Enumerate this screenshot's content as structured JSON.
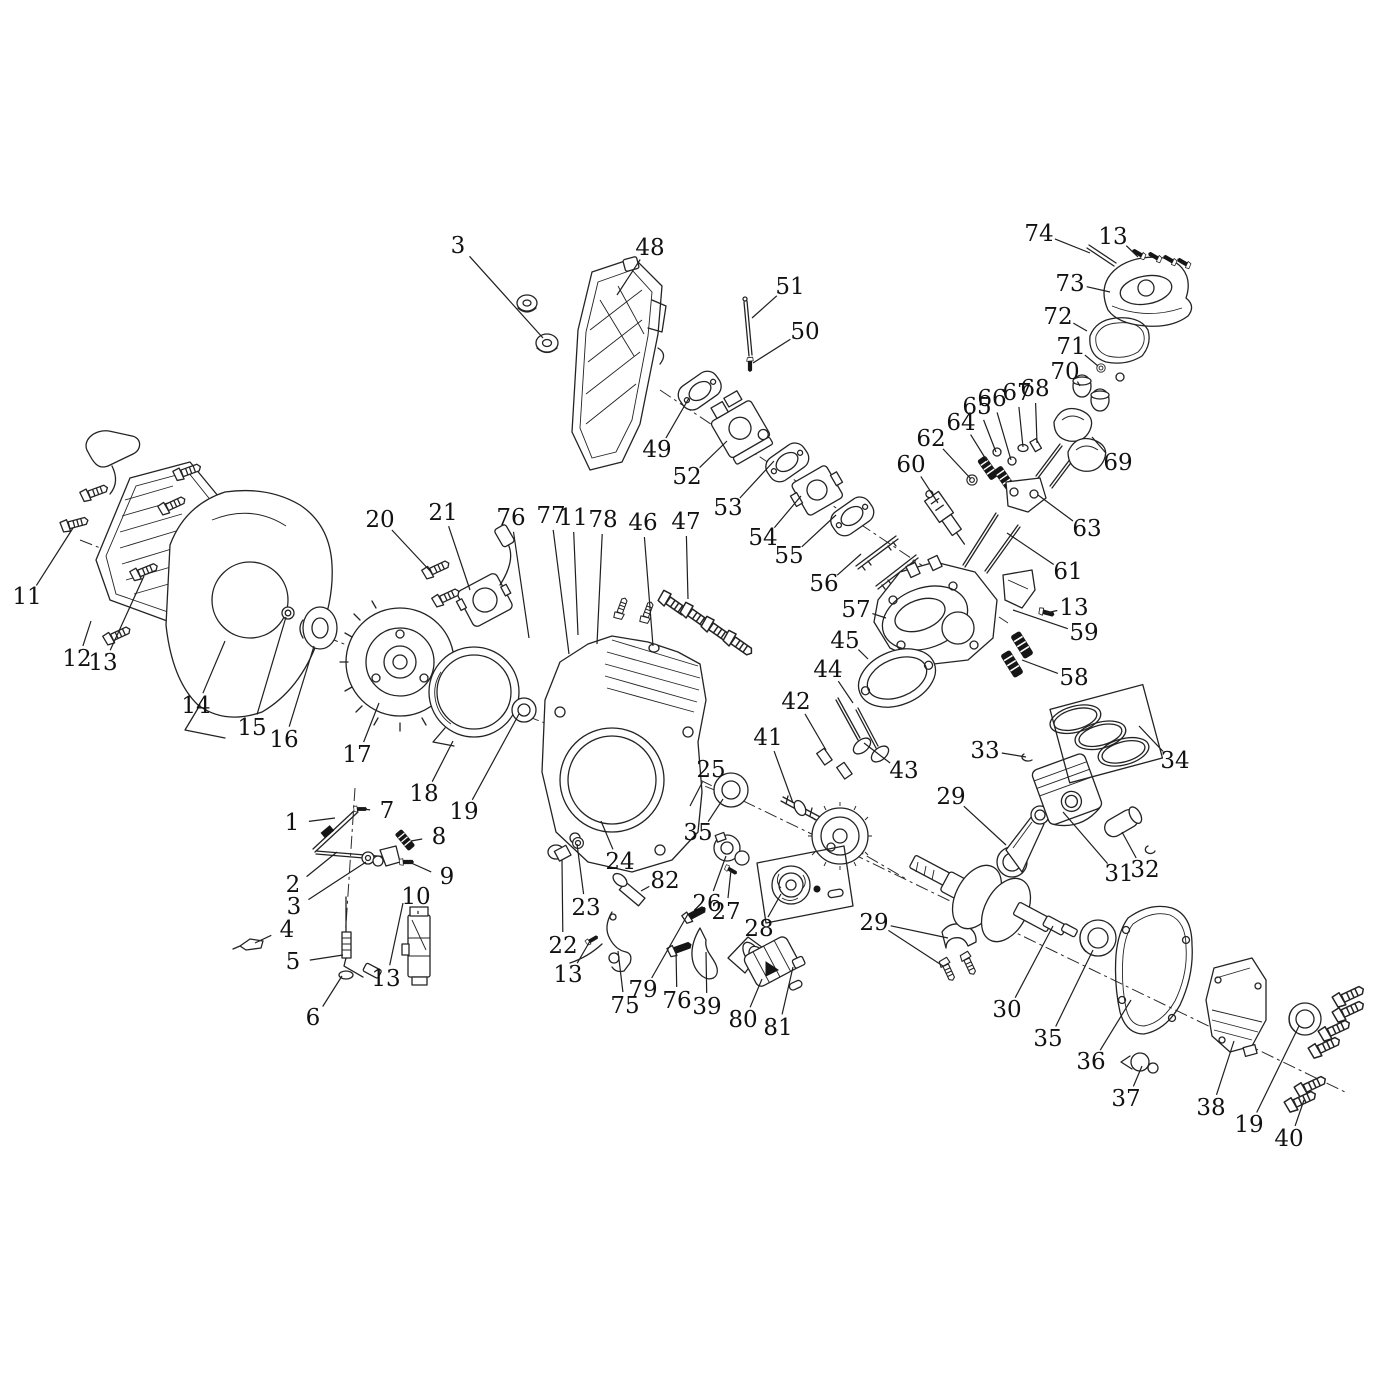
{
  "diagram": {
    "background": "#ffffff",
    "line_color": "#232323",
    "label_font_size": 23,
    "callouts": [
      {
        "n": "3",
        "x": 458,
        "y": 246,
        "t": [
          [
            543,
            338
          ]
        ]
      },
      {
        "n": "48",
        "x": 650,
        "y": 248,
        "t": [
          [
            617,
            295
          ]
        ]
      },
      {
        "n": "51",
        "x": 790,
        "y": 287,
        "t": [
          [
            752,
            318
          ]
        ]
      },
      {
        "n": "50",
        "x": 805,
        "y": 332,
        "t": [
          [
            753,
            363
          ]
        ]
      },
      {
        "n": "74",
        "x": 1039,
        "y": 234,
        "t": [
          [
            1090,
            253
          ]
        ]
      },
      {
        "n": "13",
        "x": 1113,
        "y": 237,
        "t": [
          [
            1138,
            257
          ]
        ]
      },
      {
        "n": "73",
        "x": 1070,
        "y": 284,
        "t": [
          [
            1110,
            292
          ]
        ]
      },
      {
        "n": "72",
        "x": 1058,
        "y": 317,
        "t": [
          [
            1087,
            331
          ]
        ]
      },
      {
        "n": "71",
        "x": 1071,
        "y": 347,
        "t": [
          [
            1098,
            366
          ]
        ]
      },
      {
        "n": "70",
        "x": 1065,
        "y": 372,
        "t": [
          [
            1080,
            386
          ]
        ]
      },
      {
        "n": "49",
        "x": 657,
        "y": 450,
        "t": [
          [
            689,
            398
          ]
        ]
      },
      {
        "n": "52",
        "x": 687,
        "y": 477,
        "t": [
          [
            727,
            441
          ]
        ]
      },
      {
        "n": "53",
        "x": 728,
        "y": 508,
        "t": [
          [
            774,
            461
          ]
        ]
      },
      {
        "n": "54",
        "x": 763,
        "y": 538,
        "t": [
          [
            801,
            496
          ]
        ]
      },
      {
        "n": "55",
        "x": 789,
        "y": 556,
        "t": [
          [
            836,
            515
          ]
        ]
      },
      {
        "n": "56",
        "x": 824,
        "y": 584,
        "t": [
          [
            861,
            554
          ]
        ]
      },
      {
        "n": "57",
        "x": 856,
        "y": 610,
        "t": [
          [
            886,
            618
          ]
        ]
      },
      {
        "n": "62",
        "x": 931,
        "y": 439,
        "t": [
          [
            971,
            479
          ]
        ]
      },
      {
        "n": "60",
        "x": 911,
        "y": 465,
        "t": [
          [
            938,
            503
          ]
        ]
      },
      {
        "n": "64",
        "x": 961,
        "y": 423,
        "t": [
          [
            987,
            461
          ]
        ]
      },
      {
        "n": "65",
        "x": 977,
        "y": 407,
        "t": [
          [
            996,
            452
          ]
        ]
      },
      {
        "n": "66",
        "x": 992,
        "y": 399,
        "t": [
          [
            1011,
            460
          ]
        ]
      },
      {
        "n": "67",
        "x": 1017,
        "y": 393,
        "t": [
          [
            1023,
            447
          ]
        ]
      },
      {
        "n": "68",
        "x": 1035,
        "y": 389,
        "t": [
          [
            1037,
            443
          ]
        ]
      },
      {
        "n": "69",
        "x": 1118,
        "y": 463,
        "t": [
          [
            1092,
            437
          ]
        ]
      },
      {
        "n": "63",
        "x": 1087,
        "y": 529,
        "t": [
          [
            1038,
            495
          ]
        ]
      },
      {
        "n": "61",
        "x": 1068,
        "y": 572,
        "t": [
          [
            1007,
            533
          ]
        ]
      },
      {
        "n": "13",
        "x": 1074,
        "y": 608,
        "t": [
          [
            1046,
            613
          ]
        ]
      },
      {
        "n": "59",
        "x": 1084,
        "y": 633,
        "t": [
          [
            1013,
            610
          ]
        ]
      },
      {
        "n": "58",
        "x": 1074,
        "y": 678,
        "t": [
          [
            1022,
            660
          ]
        ]
      },
      {
        "n": "45",
        "x": 845,
        "y": 641,
        "t": [
          [
            868,
            659
          ]
        ]
      },
      {
        "n": "44",
        "x": 828,
        "y": 670,
        "t": [
          [
            853,
            703
          ]
        ]
      },
      {
        "n": "42",
        "x": 796,
        "y": 702,
        "t": [
          [
            826,
            750
          ]
        ]
      },
      {
        "n": "43",
        "x": 904,
        "y": 771,
        "t": [
          [
            864,
            743
          ]
        ]
      },
      {
        "n": "41",
        "x": 768,
        "y": 738,
        "t": [
          [
            793,
            803
          ]
        ]
      },
      {
        "n": "33",
        "x": 985,
        "y": 751,
        "t": [
          [
            1026,
            757
          ]
        ]
      },
      {
        "n": "34",
        "x": 1175,
        "y": 761,
        "t": [
          [
            1139,
            726
          ]
        ]
      },
      {
        "n": "29",
        "x": 951,
        "y": 797,
        "t": [
          [
            1006,
            845
          ]
        ]
      },
      {
        "n": "31",
        "x": 1119,
        "y": 874,
        "t": [
          [
            1063,
            812
          ]
        ]
      },
      {
        "n": "32",
        "x": 1145,
        "y": 870,
        "t": [
          [
            1122,
            832
          ]
        ]
      },
      {
        "n": "11",
        "x": 27,
        "y": 597,
        "t": [
          [
            73,
            528
          ]
        ]
      },
      {
        "n": "12",
        "x": 77,
        "y": 659,
        "t": [
          [
            91,
            621
          ]
        ]
      },
      {
        "n": "13",
        "x": 103,
        "y": 663,
        "t": [
          [
            144,
            576
          ]
        ]
      },
      {
        "n": "14",
        "x": 196,
        "y": 706,
        "t": [
          [
            225,
            641
          ]
        ]
      },
      {
        "n": "15",
        "x": 252,
        "y": 728,
        "t": [
          [
            286,
            617
          ]
        ]
      },
      {
        "n": "16",
        "x": 284,
        "y": 740,
        "t": [
          [
            314,
            646
          ]
        ]
      },
      {
        "n": "17",
        "x": 357,
        "y": 755,
        "t": [
          [
            379,
            703
          ]
        ]
      },
      {
        "n": "20",
        "x": 380,
        "y": 520,
        "t": [
          [
            432,
            573
          ]
        ]
      },
      {
        "n": "18",
        "x": 424,
        "y": 794,
        "t": [
          [
            453,
            741
          ]
        ]
      },
      {
        "n": "19",
        "x": 464,
        "y": 812,
        "t": [
          [
            519,
            714
          ]
        ]
      },
      {
        "n": "21",
        "x": 443,
        "y": 513,
        "t": [
          [
            470,
            590
          ]
        ]
      },
      {
        "n": "76",
        "x": 511,
        "y": 518,
        "t": [
          [
            529,
            638
          ]
        ]
      },
      {
        "n": "77",
        "x": 551,
        "y": 516,
        "t": [
          [
            569,
            654
          ]
        ]
      },
      {
        "n": "11",
        "x": 573,
        "y": 518,
        "t": [
          [
            578,
            635
          ]
        ]
      },
      {
        "n": "78",
        "x": 603,
        "y": 520,
        "t": [
          [
            597,
            644
          ]
        ]
      },
      {
        "n": "46",
        "x": 643,
        "y": 523,
        "t": [
          [
            653,
            646
          ]
        ]
      },
      {
        "n": "47",
        "x": 686,
        "y": 522,
        "t": [
          [
            688,
            599
          ]
        ]
      },
      {
        "n": "1",
        "x": 292,
        "y": 823,
        "t": [
          [
            335,
            818
          ]
        ]
      },
      {
        "n": "7",
        "x": 387,
        "y": 811,
        "t": [
          [
            362,
            809
          ]
        ]
      },
      {
        "n": "8",
        "x": 439,
        "y": 837,
        "t": [
          [
            411,
            841
          ]
        ]
      },
      {
        "n": "2",
        "x": 293,
        "y": 885,
        "t": [
          [
            337,
            852
          ]
        ]
      },
      {
        "n": "3",
        "x": 294,
        "y": 907,
        "t": [
          [
            366,
            862
          ]
        ]
      },
      {
        "n": "9",
        "x": 447,
        "y": 877,
        "t": [
          [
            409,
            862
          ]
        ]
      },
      {
        "n": "4",
        "x": 287,
        "y": 930,
        "t": [
          [
            255,
            943
          ]
        ]
      },
      {
        "n": "5",
        "x": 293,
        "y": 962,
        "t": [
          [
            343,
            955
          ]
        ]
      },
      {
        "n": "6",
        "x": 313,
        "y": 1018,
        "t": [
          [
            342,
            976
          ]
        ]
      },
      {
        "n": "10",
        "x": 416,
        "y": 897,
        "t": [
          [
            418,
            914
          ]
        ]
      },
      {
        "n": "13",
        "x": 386,
        "y": 979,
        "t": [
          [
            403,
            903
          ]
        ]
      },
      {
        "n": "24",
        "x": 620,
        "y": 862,
        "t": [
          [
            601,
            821
          ]
        ]
      },
      {
        "n": "23",
        "x": 586,
        "y": 908,
        "t": [
          [
            577,
            844
          ]
        ]
      },
      {
        "n": "22",
        "x": 563,
        "y": 946,
        "t": [
          [
            562,
            860
          ]
        ]
      },
      {
        "n": "13",
        "x": 568,
        "y": 975,
        "t": [
          [
            590,
            941
          ]
        ]
      },
      {
        "n": "75",
        "x": 625,
        "y": 1006,
        "t": [
          [
            618,
            951
          ]
        ]
      },
      {
        "n": "79",
        "x": 643,
        "y": 990,
        "t": [
          [
            688,
            914
          ]
        ]
      },
      {
        "n": "76",
        "x": 677,
        "y": 1001,
        "t": [
          [
            676,
            949
          ]
        ]
      },
      {
        "n": "39",
        "x": 707,
        "y": 1007,
        "t": [
          [
            706,
            952
          ]
        ]
      },
      {
        "n": "80",
        "x": 743,
        "y": 1020,
        "t": [
          [
            762,
            979
          ]
        ]
      },
      {
        "n": "81",
        "x": 778,
        "y": 1028,
        "t": [
          [
            793,
            967
          ]
        ]
      },
      {
        "n": "82",
        "x": 665,
        "y": 881,
        "t": [
          [
            641,
            891
          ]
        ]
      },
      {
        "n": "25",
        "x": 711,
        "y": 770,
        "t": [
          [
            690,
            806
          ]
        ]
      },
      {
        "n": "35",
        "x": 698,
        "y": 833,
        "t": [
          [
            723,
            799
          ]
        ]
      },
      {
        "n": "26",
        "x": 707,
        "y": 904,
        "t": [
          [
            726,
            856
          ]
        ]
      },
      {
        "n": "27",
        "x": 726,
        "y": 912,
        "t": [
          [
            731,
            870
          ]
        ]
      },
      {
        "n": "28",
        "x": 759,
        "y": 929,
        "t": [
          [
            781,
            894
          ]
        ]
      },
      {
        "n": "29",
        "x": 874,
        "y": 923,
        "t": [
          [
            948,
            938
          ],
          [
            943,
            966
          ]
        ]
      },
      {
        "n": "30",
        "x": 1007,
        "y": 1010,
        "t": [
          [
            1053,
            926
          ]
        ]
      },
      {
        "n": "35",
        "x": 1048,
        "y": 1039,
        "t": [
          [
            1093,
            950
          ]
        ]
      },
      {
        "n": "36",
        "x": 1091,
        "y": 1062,
        "t": [
          [
            1131,
            1000
          ]
        ]
      },
      {
        "n": "37",
        "x": 1126,
        "y": 1099,
        "t": [
          [
            1142,
            1066
          ]
        ]
      },
      {
        "n": "38",
        "x": 1211,
        "y": 1108,
        "t": [
          [
            1234,
            1041
          ]
        ]
      },
      {
        "n": "19",
        "x": 1249,
        "y": 1125,
        "t": [
          [
            1299,
            1026
          ]
        ]
      },
      {
        "n": "40",
        "x": 1289,
        "y": 1139,
        "t": [
          [
            1304,
            1100
          ]
        ]
      }
    ]
  }
}
